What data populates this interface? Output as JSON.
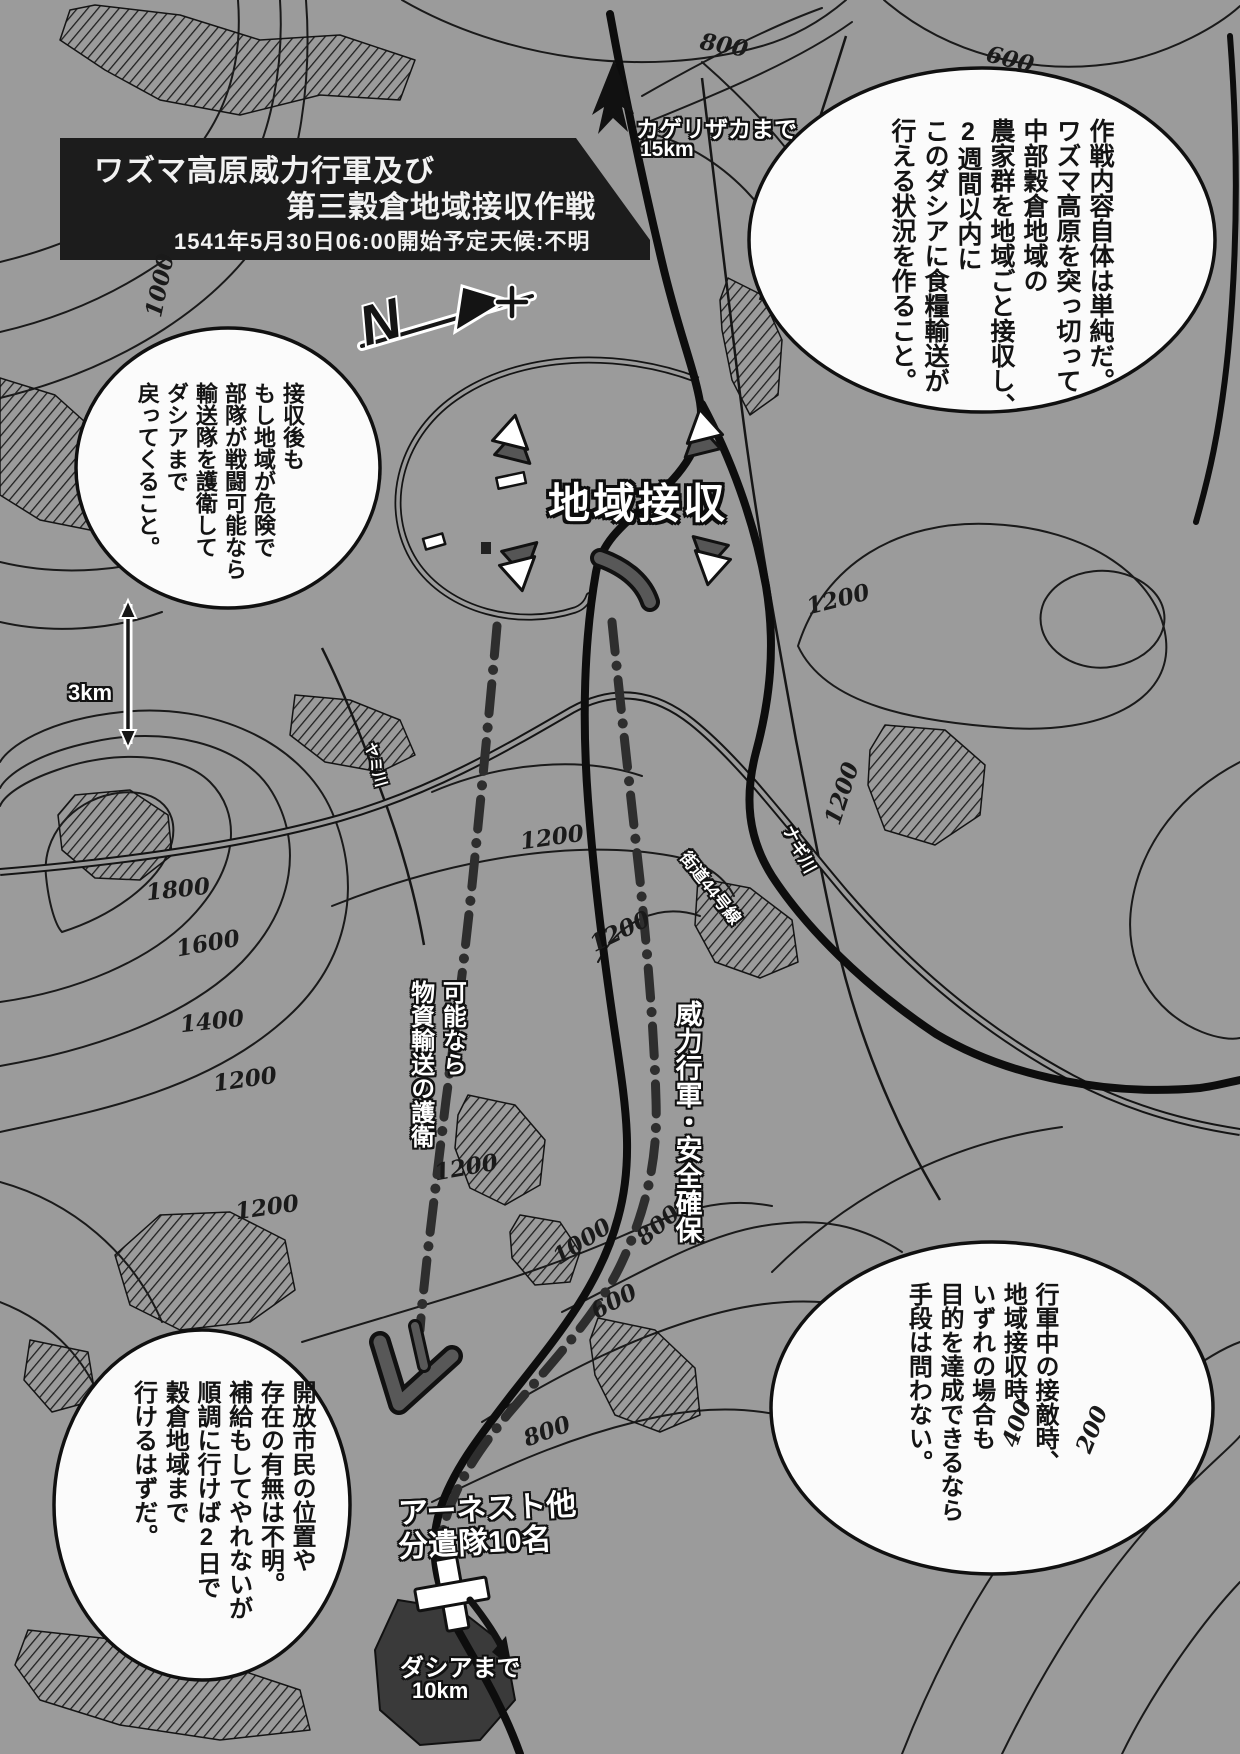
{
  "colors": {
    "background": "#9b9b9b",
    "ink": "#161616",
    "bubble_fill": "#fbfbfb",
    "title_panel": "#1c1c1c",
    "marker_gray": "#555555",
    "label_white": "#ffffff"
  },
  "title_box": {
    "line1": "ワズマ高原威力行軍及び",
    "line2": "第三穀倉地域接収作戦",
    "schedule": "1541年5月30日06:00開始予定",
    "weather": "天候:不明"
  },
  "bubbles": {
    "operation": {
      "lines": [
        "作戦内容自体は単純だ。",
        "ワズマ高原を突っ切って",
        "中部穀倉地域の",
        "農家群を地域ごと接収し、",
        "2週間以内に",
        "このダシアに食糧輸送が",
        "行える状況を作ること。"
      ]
    },
    "post_seizure": {
      "lines": [
        "接収後も",
        "もし地域が危険で",
        "部隊が戦闘可能なら",
        "輸送隊を護衛して",
        "ダシアまで",
        "戻ってくること。"
      ]
    },
    "engagement": {
      "lines": [
        "行軍中の接敵時、",
        "地域接収時、",
        "いずれの場合も",
        "目的を達成できるなら",
        "手段は問わない。"
      ]
    },
    "citizens": {
      "lines": [
        "開放市民の位置や",
        "存在の有無は不明。",
        "補給もしてやれないが",
        "順調に行けば2日で",
        "穀倉地域まで",
        "行けるはずだ。"
      ]
    }
  },
  "map_labels": {
    "area_seizure": "地域接収",
    "kagerizaka": "カゲリザカまで",
    "kagerizaka_distance": "15km",
    "scale": "3km",
    "march_security": "威力行軍・安全確保",
    "escort_line1": "可能なら",
    "escort_line2": "物資輸送の護衛",
    "road_44": "街道44号線",
    "nagi_river": "ナギ川",
    "yami_river": "ヤミ川",
    "ernest": "アーネスト他",
    "detachment": "分遣隊10名",
    "dashia": "ダシアまで",
    "dashia_distance": "10km"
  },
  "compass": {
    "letter": "N"
  },
  "contour_labels": [
    "1000",
    "800",
    "600",
    "1200",
    "1200",
    "1800",
    "1600",
    "1400",
    "1200",
    "1200",
    "1200",
    "1200",
    "1200",
    "1000",
    "800",
    "600",
    "800",
    "400",
    "200"
  ]
}
